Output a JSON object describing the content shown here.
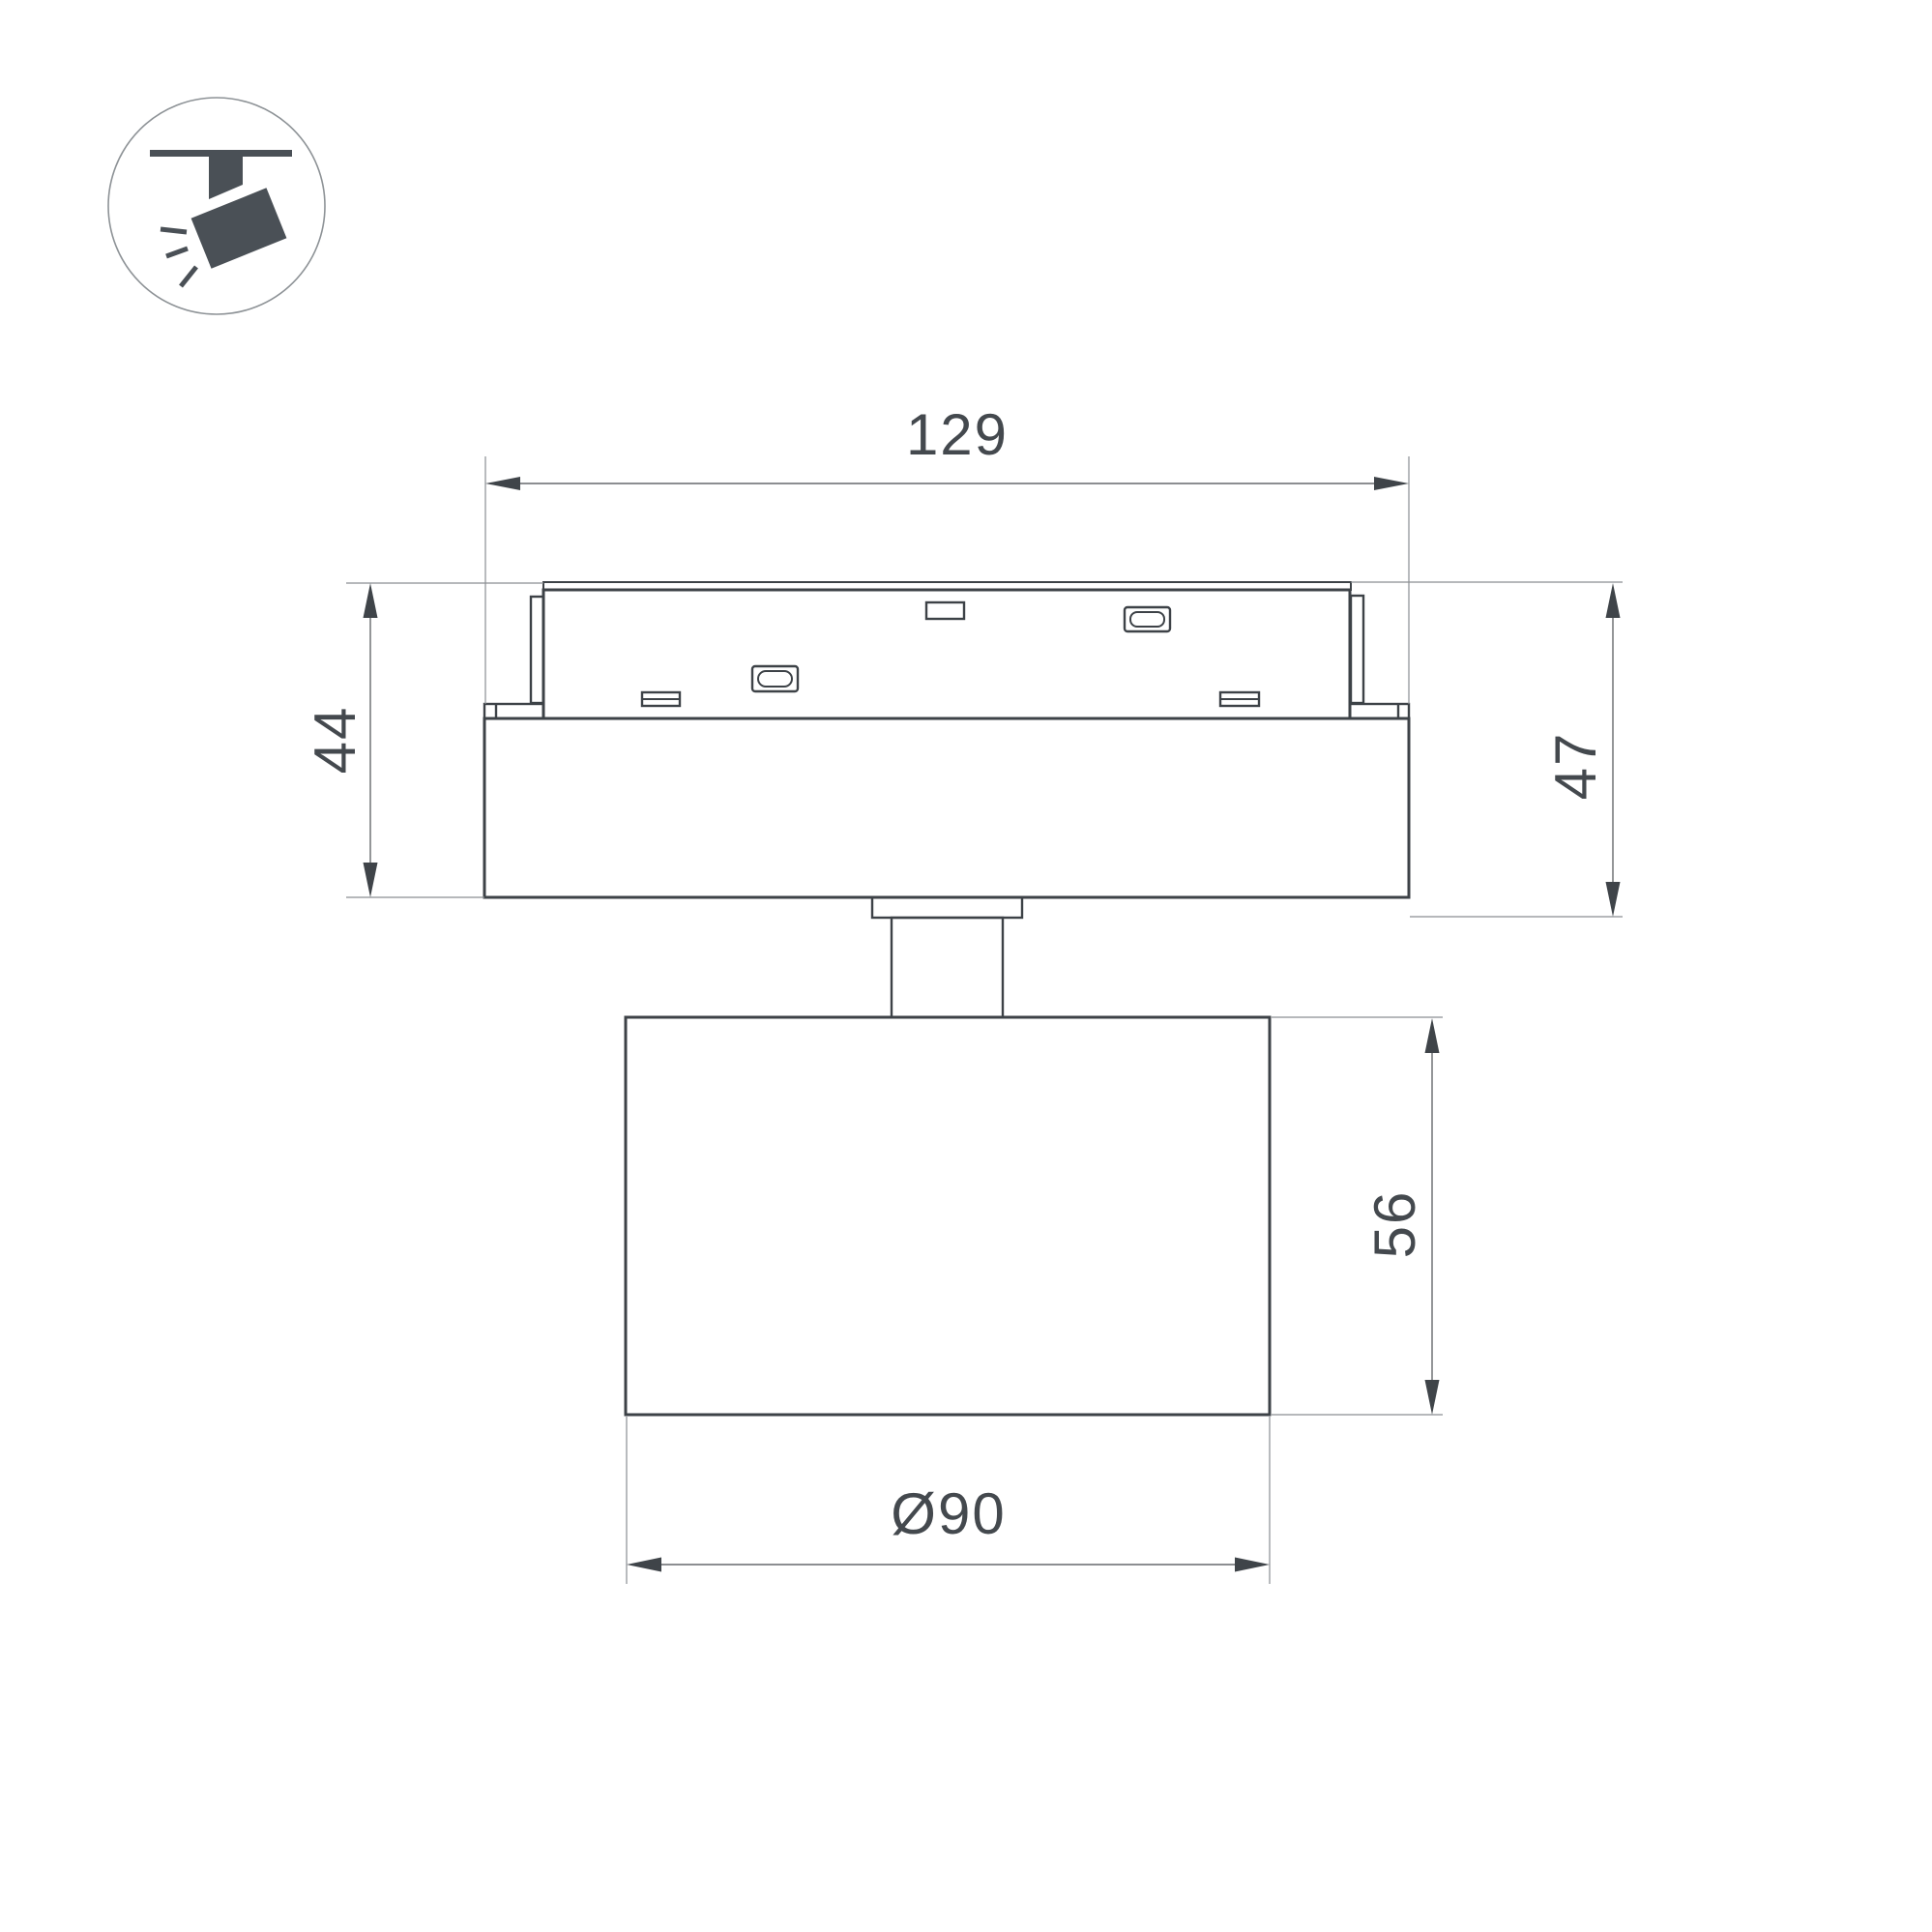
{
  "drawing": {
    "type": "technical-dimension-drawing",
    "subject": "track-mounted spotlight, side view with track adapter",
    "icon": "ceiling-track-spotlight",
    "labels": {
      "width_overall": "129",
      "height_adapter": "44",
      "height_right": "47",
      "height_head": "56",
      "diameter_head": "Ø90"
    },
    "colors": {
      "outline": "#3d4247",
      "thin": "#8a8e92",
      "dim": "#66696d",
      "dimdark": "#3f4449",
      "text": "#44494e",
      "icon": "#4a5056",
      "bg": "#ffffff"
    }
  }
}
